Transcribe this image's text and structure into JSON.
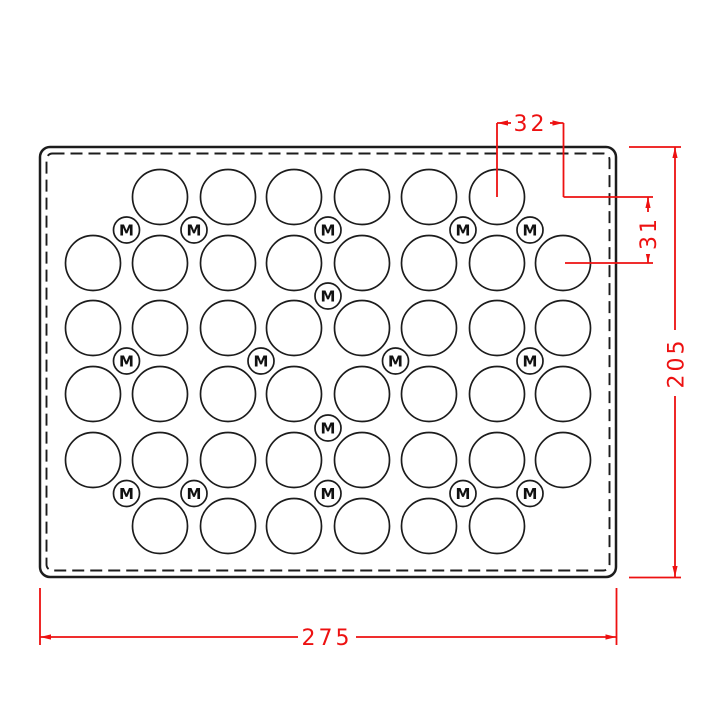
{
  "drawing": {
    "title": "perforated-plate-technical-drawing",
    "m_label": "M",
    "colors": {
      "line": "#1c1c1c",
      "dimension": "#ed1111",
      "background": "#ffffff"
    },
    "plate": {
      "x": 40,
      "y": 147,
      "width": 576,
      "height": 430,
      "corner_radius": 10,
      "dashed_inset": 6.5,
      "dashed_corner_radius": 6,
      "dash_pattern": "12 6"
    },
    "hole_radius": 27.5,
    "m_hole_radius": 13,
    "columns_x": [
      93,
      160,
      228,
      294,
      362,
      429,
      497,
      563
    ],
    "rows": [
      {
        "y": 197,
        "cols": [
          1,
          2,
          3,
          4,
          5,
          6
        ]
      },
      {
        "y": 263,
        "cols": [
          0,
          1,
          2,
          3,
          4,
          5,
          6,
          7
        ]
      },
      {
        "y": 328,
        "cols": [
          0,
          1,
          2,
          3,
          4,
          5,
          6,
          7
        ]
      },
      {
        "y": 394,
        "cols": [
          0,
          1,
          2,
          3,
          4,
          5,
          6,
          7
        ]
      },
      {
        "y": 460,
        "cols": [
          0,
          1,
          2,
          3,
          4,
          5,
          6,
          7
        ]
      },
      {
        "y": 526,
        "cols": [
          1,
          2,
          3,
          4,
          5,
          6
        ]
      }
    ],
    "m_hole_bands": [
      {
        "y": 230,
        "xs": [
          126.5,
          194,
          328,
          463,
          530
        ]
      },
      {
        "y": 296,
        "xs": [
          328
        ]
      },
      {
        "y": 361,
        "xs": [
          126.5,
          261,
          395.5,
          530
        ]
      },
      {
        "y": 428,
        "xs": [
          328
        ]
      },
      {
        "y": 493.5,
        "xs": [
          126.5,
          194,
          328,
          463,
          530
        ]
      }
    ],
    "dimensions": [
      {
        "id": "hole-pitch-x",
        "label": "32",
        "rotated": false,
        "lines": [
          [
            497,
            123,
            563.5,
            123
          ],
          [
            497,
            123,
            497,
            197
          ],
          [
            563.5,
            123,
            563.5,
            197
          ],
          [
            563.5,
            197,
            653,
            197
          ]
        ],
        "arrows": [
          {
            "x": 497,
            "y": 123,
            "dir": "left"
          },
          {
            "x": 563.5,
            "y": 123,
            "dir": "right"
          }
        ],
        "box": {
          "x": 511,
          "y": 112,
          "w": 39,
          "h": 22
        },
        "text": {
          "x": 530.5,
          "y": 123
        }
      },
      {
        "id": "hole-pitch-y",
        "label": "31",
        "rotated": true,
        "lines": [
          [
            648,
            197,
            648,
            263
          ],
          [
            565,
            263,
            653,
            263
          ]
        ],
        "arrows": [
          {
            "x": 648,
            "y": 197,
            "dir": "up"
          },
          {
            "x": 648,
            "y": 263,
            "dir": "down"
          }
        ],
        "box": {
          "x": 637,
          "y": 212,
          "w": 23,
          "h": 42
        },
        "text": {
          "x": 648,
          "y": 233
        }
      },
      {
        "id": "plate-height",
        "label": "205",
        "rotated": true,
        "lines": [
          [
            675,
            147,
            675,
            577
          ],
          [
            629,
            147,
            681,
            147
          ],
          [
            629,
            577.5,
            681,
            577.5
          ]
        ],
        "arrows": [
          {
            "x": 675,
            "y": 147,
            "dir": "up"
          },
          {
            "x": 675,
            "y": 577,
            "dir": "down"
          }
        ],
        "box": {
          "x": 662,
          "y": 330,
          "w": 26,
          "h": 66
        },
        "text": {
          "x": 675.5,
          "y": 363
        }
      },
      {
        "id": "plate-width",
        "label": "275",
        "rotated": false,
        "lines": [
          [
            40,
            637,
            616.5,
            637
          ],
          [
            40,
            588,
            40,
            645
          ],
          [
            616.5,
            588,
            616.5,
            645
          ]
        ],
        "arrows": [
          {
            "x": 40,
            "y": 637,
            "dir": "left"
          },
          {
            "x": 616.5,
            "y": 637,
            "dir": "right"
          }
        ],
        "box": {
          "x": 298,
          "y": 626,
          "w": 58,
          "h": 22
        },
        "text": {
          "x": 327,
          "y": 637
        }
      }
    ]
  }
}
